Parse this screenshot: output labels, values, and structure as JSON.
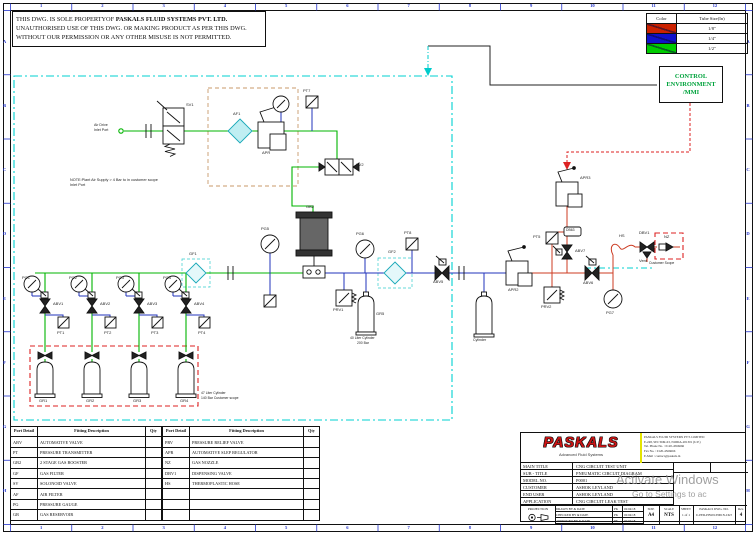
{
  "sheet": {
    "cols": [
      "1",
      "2",
      "3",
      "4",
      "5",
      "6",
      "7",
      "8",
      "9",
      "10",
      "11",
      "12"
    ],
    "rows": [
      "A",
      "B",
      "C",
      "D",
      "E",
      "F",
      "G",
      "H"
    ]
  },
  "disclaimer": {
    "line1_prefix": "THIS DWG. IS SOLE PROPERTYOF ",
    "line1_bold": "PASKALS FLUID SYSTEMS PVT. LTD.",
    "line2": "UNAUTHORISED USE OF THIS DWG. OR MAKING PRODUCT AS PER THIS DWG.",
    "line3": "WITHOUT OUR PERMISSION OR ANY OTHER MISUSE IS NOT PERMITTED."
  },
  "tube_legend": {
    "headers": [
      "Color",
      "Tube Size(In)"
    ],
    "rows": [
      {
        "color": "#cc2200",
        "size": "1/8\""
      },
      {
        "color": "#1111cc",
        "size": "1/4\""
      },
      {
        "color": "#00cc00",
        "size": "1/2\""
      }
    ]
  },
  "control_box": {
    "line1": "CONTROL",
    "line2": "ENVIRONMENT",
    "line3": "/MMI"
  },
  "fitting_table": {
    "header_port": "Port Detail",
    "header_desc": "Fitting Description",
    "header_qty": "Qty",
    "left_rows": [
      [
        "ABV",
        "AUTOMATIVE VALVE",
        ""
      ],
      [
        "PT",
        "PRESSURE TRANSMITTER",
        ""
      ],
      [
        "GB2",
        "2 STAGE GAS BOOSTER",
        ""
      ],
      [
        "GF",
        "GAS FILTER",
        ""
      ],
      [
        "SV",
        "SOLONOID VALVE",
        ""
      ],
      [
        "AF",
        "AIR FILTER",
        ""
      ],
      [
        "PG",
        "PRESSURE GAUGE",
        ""
      ],
      [
        "GR",
        "GAS RESERVOIR",
        ""
      ]
    ],
    "right_rows": [
      [
        "PRV",
        "PRESSURE RELIEF VALVE",
        ""
      ],
      [
        "APR",
        "AUTOMATIVE SLEP REGULATOR",
        ""
      ],
      [
        "NZ",
        "GAS NOZZLE",
        ""
      ],
      [
        "DBV1",
        "DISPENSING  VALVE",
        ""
      ],
      [
        "HS",
        "THERMOPLASTIC HOSE",
        ""
      ]
    ]
  },
  "title_block": {
    "logo": "PASKALS",
    "logo_sub": "Advanced Fluid Systems",
    "address_lines": [
      "PASKALS FLUID SYSTEMS PVT. LIMITED",
      "E-248, SECTOR-63, NOIDA-201301 (U.P.)",
      "Tel. Phone No. : 0120-4566666",
      "Fax No. : 0120-4566666",
      "E-Mail : contact@paskals.in"
    ],
    "rows": [
      {
        "label": "MAIN TITLE",
        "value": "CNG CIRCUIT TEST UNIT"
      },
      {
        "label": "SUB - TITLE",
        "value": "PNEUMATIC CIRCUIT DIAGRAM"
      },
      {
        "label": "MODEL NO.",
        "value": "P0001"
      },
      {
        "label": "CUSTOMER",
        "value": "ASHOK LEYLAND"
      },
      {
        "label": "END USER",
        "value": "ASHOK LEYLAND"
      },
      {
        "label": "APPLICATION",
        "value": "CNG CIRCUIT LEAK TEST"
      }
    ],
    "projection_label": "PROJECTION",
    "sign_rows": [
      {
        "label": "DRAWN BY & DATE",
        "initial": "PK",
        "date": "02/04/18"
      },
      {
        "label": "CHECKED BY & DATE",
        "initial": "PK",
        "date": "02/04/18"
      },
      {
        "label": "APPROVED BY & DATE",
        "initial": "PK",
        "date": "02/04/18"
      }
    ],
    "size_label": "SIZE",
    "size_value": "A4",
    "scale_label": "SCALE",
    "scale_value": "NTS",
    "sheet_label": "SHEET",
    "sheet_value": "1 of 1",
    "dwg_label": "PASKALS DWG. NO.",
    "dwg_value": "U-PED-P0W01/P001N-CKT",
    "rev_label": "Rev.",
    "rev_value": "4"
  },
  "watermark": {
    "line1": "Activate Windows",
    "line2": "Go to Settings to ac"
  },
  "diagram": {
    "labels": [
      {
        "t": "Air Drive",
        "x": 94,
        "y": 124,
        "fs": 3.6
      },
      {
        "t": "Inlet Port",
        "x": 94,
        "y": 129,
        "fs": 3.6
      },
      {
        "t": "SV1",
        "x": 186,
        "y": 103
      },
      {
        "t": "AF1",
        "x": 233,
        "y": 112
      },
      {
        "t": "APR",
        "x": 262,
        "y": 151
      },
      {
        "t": "PT7",
        "x": 303,
        "y": 89
      },
      {
        "t": "SV2",
        "x": 356,
        "y": 163
      },
      {
        "t": "GB2",
        "x": 306,
        "y": 205
      },
      {
        "t": "NOTE:Plant Air Supply > 4 Bar to in customer scope",
        "x": 70,
        "y": 179,
        "fs": 3.8
      },
      {
        "t": "Inlet Port",
        "x": 70,
        "y": 184,
        "fs": 3.8
      },
      {
        "t": "GF1",
        "x": 189,
        "y": 252
      },
      {
        "t": "PG5",
        "x": 261,
        "y": 227
      },
      {
        "t": "PG6",
        "x": 356,
        "y": 232
      },
      {
        "t": "PT8",
        "x": 404,
        "y": 231
      },
      {
        "t": "GF2",
        "x": 388,
        "y": 250
      },
      {
        "t": "ABV5",
        "x": 433,
        "y": 280
      },
      {
        "t": "APR2",
        "x": 508,
        "y": 288
      },
      {
        "t": "PT5",
        "x": 533,
        "y": 235
      },
      {
        "t": "DB63",
        "x": 566,
        "y": 229,
        "fs": 3.4
      },
      {
        "t": "PRV1",
        "x": 333,
        "y": 308
      },
      {
        "t": "PRV2",
        "x": 541,
        "y": 305
      },
      {
        "t": "APR3",
        "x": 580,
        "y": 176
      },
      {
        "t": "ABV7",
        "x": 575,
        "y": 249
      },
      {
        "t": "ABV6",
        "x": 583,
        "y": 281
      },
      {
        "t": "PG7",
        "x": 606,
        "y": 311
      },
      {
        "t": "HS",
        "x": 619,
        "y": 234
      },
      {
        "t": "DBV1",
        "x": 639,
        "y": 231
      },
      {
        "t": "Vent",
        "x": 639,
        "y": 259
      },
      {
        "t": "NZ",
        "x": 664,
        "y": 235
      },
      {
        "t": "Customer Scope",
        "x": 649,
        "y": 262,
        "fs": 3.4
      },
      {
        "t": "Cylinder",
        "x": 473,
        "y": 339,
        "fs": 3.6
      },
      {
        "t": "GR5",
        "x": 376,
        "y": 312
      },
      {
        "t": "40 Liter Cylinder",
        "x": 350,
        "y": 337,
        "fs": 3.4
      },
      {
        "t": "200 Bar",
        "x": 357,
        "y": 342,
        "fs": 3.4
      },
      {
        "t": "PG1",
        "x": 22,
        "y": 276
      },
      {
        "t": "PG2",
        "x": 69,
        "y": 276
      },
      {
        "t": "PG3",
        "x": 116,
        "y": 276
      },
      {
        "t": "PG4",
        "x": 163,
        "y": 276
      },
      {
        "t": "ABV1",
        "x": 53,
        "y": 302
      },
      {
        "t": "ABV2",
        "x": 100,
        "y": 302
      },
      {
        "t": "ABV3",
        "x": 147,
        "y": 302
      },
      {
        "t": "ABV4",
        "x": 194,
        "y": 302
      },
      {
        "t": "PT1",
        "x": 57,
        "y": 331
      },
      {
        "t": "PT2",
        "x": 104,
        "y": 331
      },
      {
        "t": "PT3",
        "x": 151,
        "y": 331
      },
      {
        "t": "PT4",
        "x": 198,
        "y": 331
      },
      {
        "t": "GR1",
        "x": 39,
        "y": 399
      },
      {
        "t": "GR2",
        "x": 86,
        "y": 399
      },
      {
        "t": "GR3",
        "x": 133,
        "y": 399
      },
      {
        "t": "GR4",
        "x": 180,
        "y": 399
      },
      {
        "t": "47 Liter Cylinder",
        "x": 201,
        "y": 392,
        "fs": 3.4
      },
      {
        "t": "140 Bar Customer scope",
        "x": 201,
        "y": 397,
        "fs": 3.4
      }
    ]
  }
}
